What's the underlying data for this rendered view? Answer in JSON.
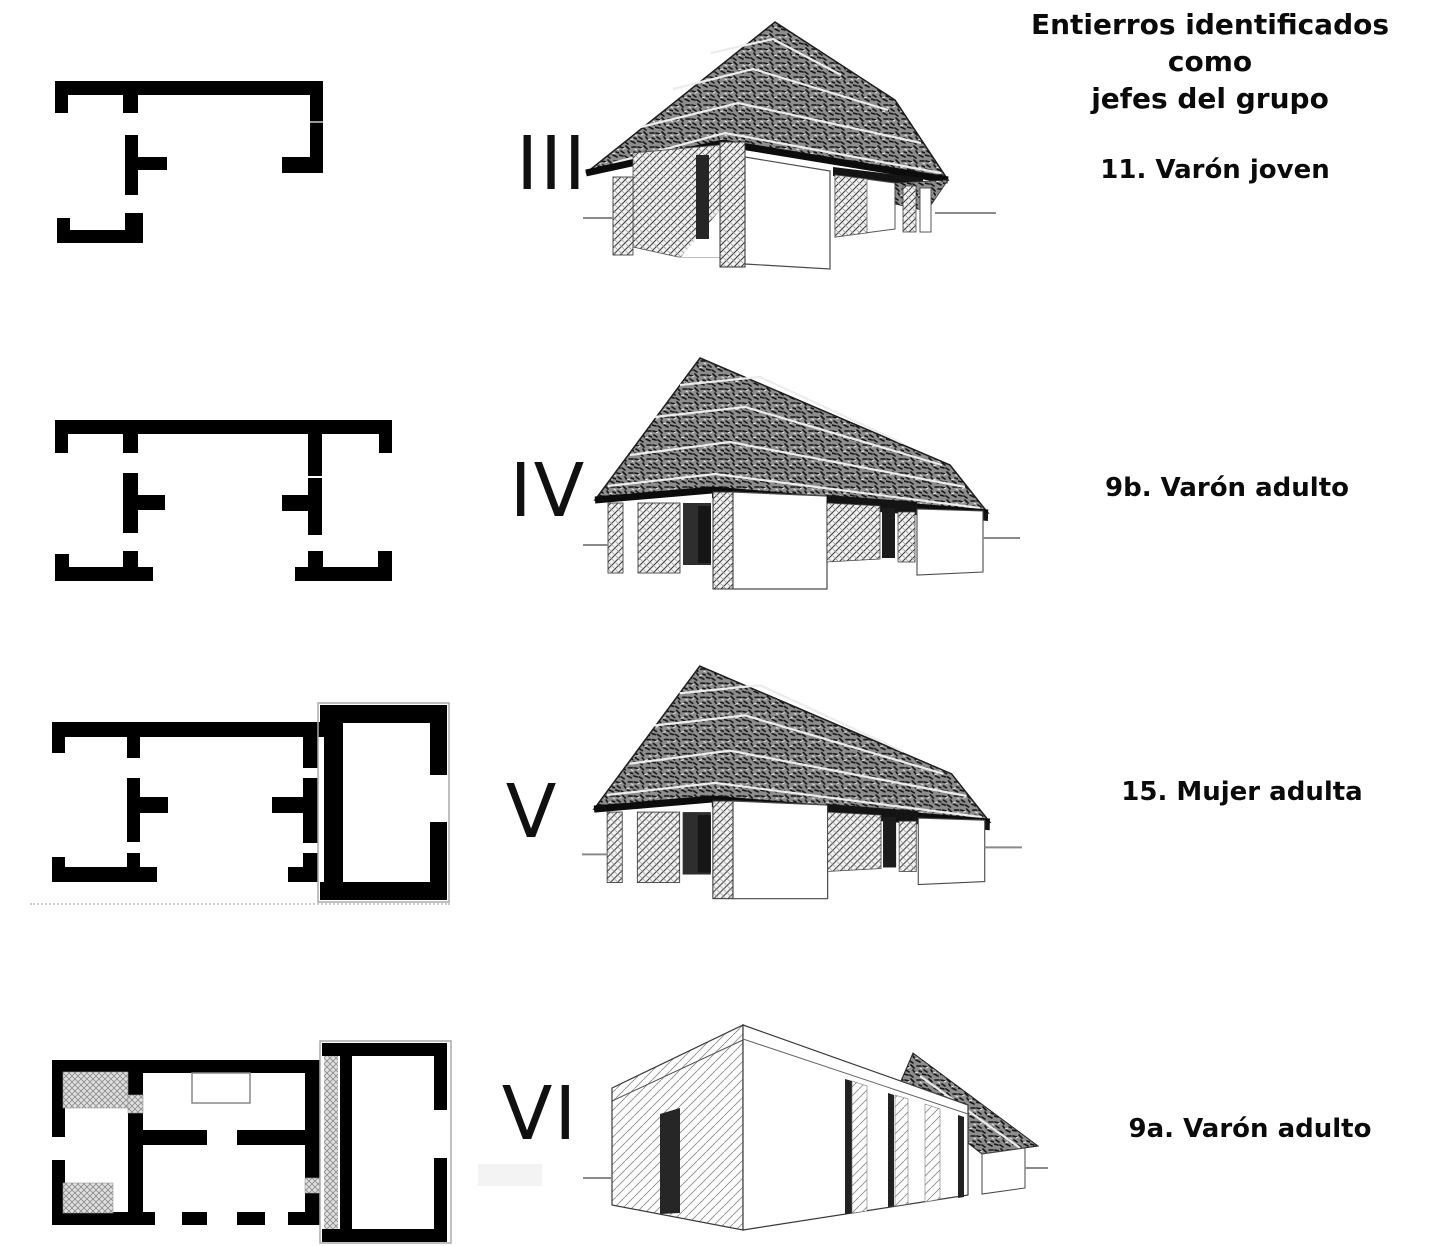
{
  "header": {
    "line1": "Entierros identificados como",
    "line2": "jefes del grupo"
  },
  "rows": [
    {
      "phase": "III",
      "label": "11. Varón joven"
    },
    {
      "phase": "IV",
      "label": "9b. Varón adulto"
    },
    {
      "phase": "V",
      "label": "15. Mujer adulta"
    },
    {
      "phase": "VI",
      "label": "9a. Varón adulto"
    }
  ],
  "colors": {
    "ink": "#000000",
    "background": "#ffffff",
    "thatch_gray": "#8d8d8d"
  }
}
